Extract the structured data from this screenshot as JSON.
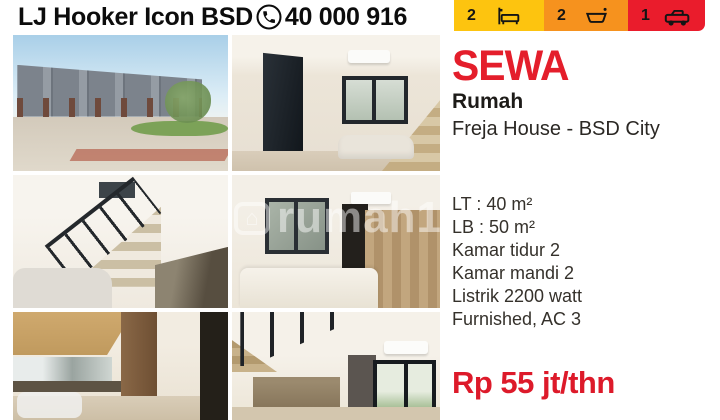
{
  "header": {
    "agency": "LJ Hooker Icon BSD",
    "phone": "40 000 916"
  },
  "badges": {
    "bedrooms": {
      "count": "2",
      "icon": "bed-icon",
      "color": "#FDC40F"
    },
    "bathrooms": {
      "count": "2",
      "icon": "bath-icon",
      "color": "#F6921E"
    },
    "garage": {
      "count": "1",
      "icon": "car-icon",
      "color": "#EA1C2C"
    }
  },
  "listing": {
    "transaction": "SEWA",
    "property_type": "Rumah",
    "title": "Freja House - BSD City",
    "details": [
      "LT : 40 m²",
      "LB : 50 m²",
      "Kamar tidur 2",
      "Kamar mandi 2",
      "Listrik 2200 watt",
      "Furnished, AC 3"
    ],
    "price": "Rp 55 jt/thn"
  },
  "watermark": {
    "glyph": "⌂",
    "text": "rumah12"
  },
  "colors": {
    "accent_red": "#E41E2B",
    "price_red": "#DD1A2A",
    "badge_yellow": "#FDC40F",
    "badge_orange": "#F6921E",
    "badge_red": "#EA1C2C"
  },
  "photos": [
    {
      "label": "townhouse exterior"
    },
    {
      "label": "living room"
    },
    {
      "label": "stairs and kitchen"
    },
    {
      "label": "bedroom"
    },
    {
      "label": "kitchen corridor"
    },
    {
      "label": "dining area with stairs"
    }
  ]
}
